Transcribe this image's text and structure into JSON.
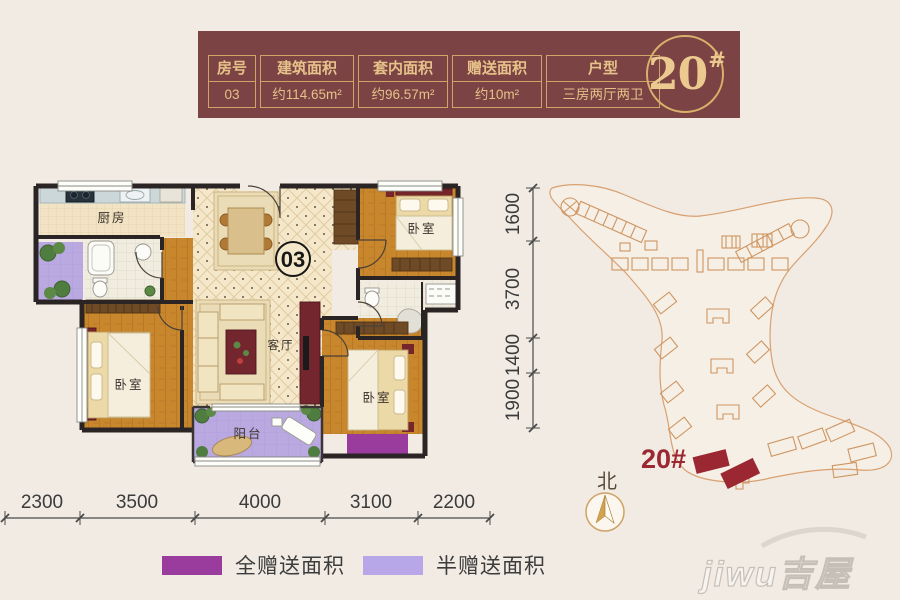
{
  "page": {
    "background": "#f1ebe3"
  },
  "colors": {
    "band_bg": "#7b4344",
    "gold_border": "#cfa469",
    "gold_text": "#e6c189",
    "accent_red": "#9b2732",
    "full_gift_purple": "#993c9e",
    "half_gift_purple": "#b7a7e8",
    "wood_floor": "#c8862d",
    "tile_floor": "#f5e8ca",
    "wall_black": "#2b2424",
    "site_line_orange": "#cf9560"
  },
  "header": {
    "columns": [
      "房号",
      "建筑面积",
      "套内面积",
      "赠送面积",
      "户型"
    ],
    "values": [
      "03",
      "约114.65m²",
      "约96.57m²",
      "约10m²",
      "三房两厅两卫"
    ],
    "badge": {
      "number": "20",
      "hash": "#"
    }
  },
  "floorplan": {
    "unit_circle": "03",
    "labels": {
      "kitchen": "厨房",
      "living": "客厅",
      "balcony": "阳台",
      "bedroom_left": "卧室",
      "bedroom_top_right": "卧室",
      "bedroom_bottom_right": "卧室"
    },
    "dims_bottom": [
      "2300",
      "3500",
      "4000",
      "3100",
      "2200"
    ],
    "dims_right": [
      "1600",
      "3700",
      "1400",
      "1900"
    ]
  },
  "sitemap": {
    "building_label": "20#",
    "north_label": "北"
  },
  "legend": {
    "full": {
      "label": "全赠送面积",
      "color": "#993c9e"
    },
    "half": {
      "label": "半赠送面积",
      "color": "#b7a7e8"
    }
  },
  "watermark": "jiwu吉屋"
}
